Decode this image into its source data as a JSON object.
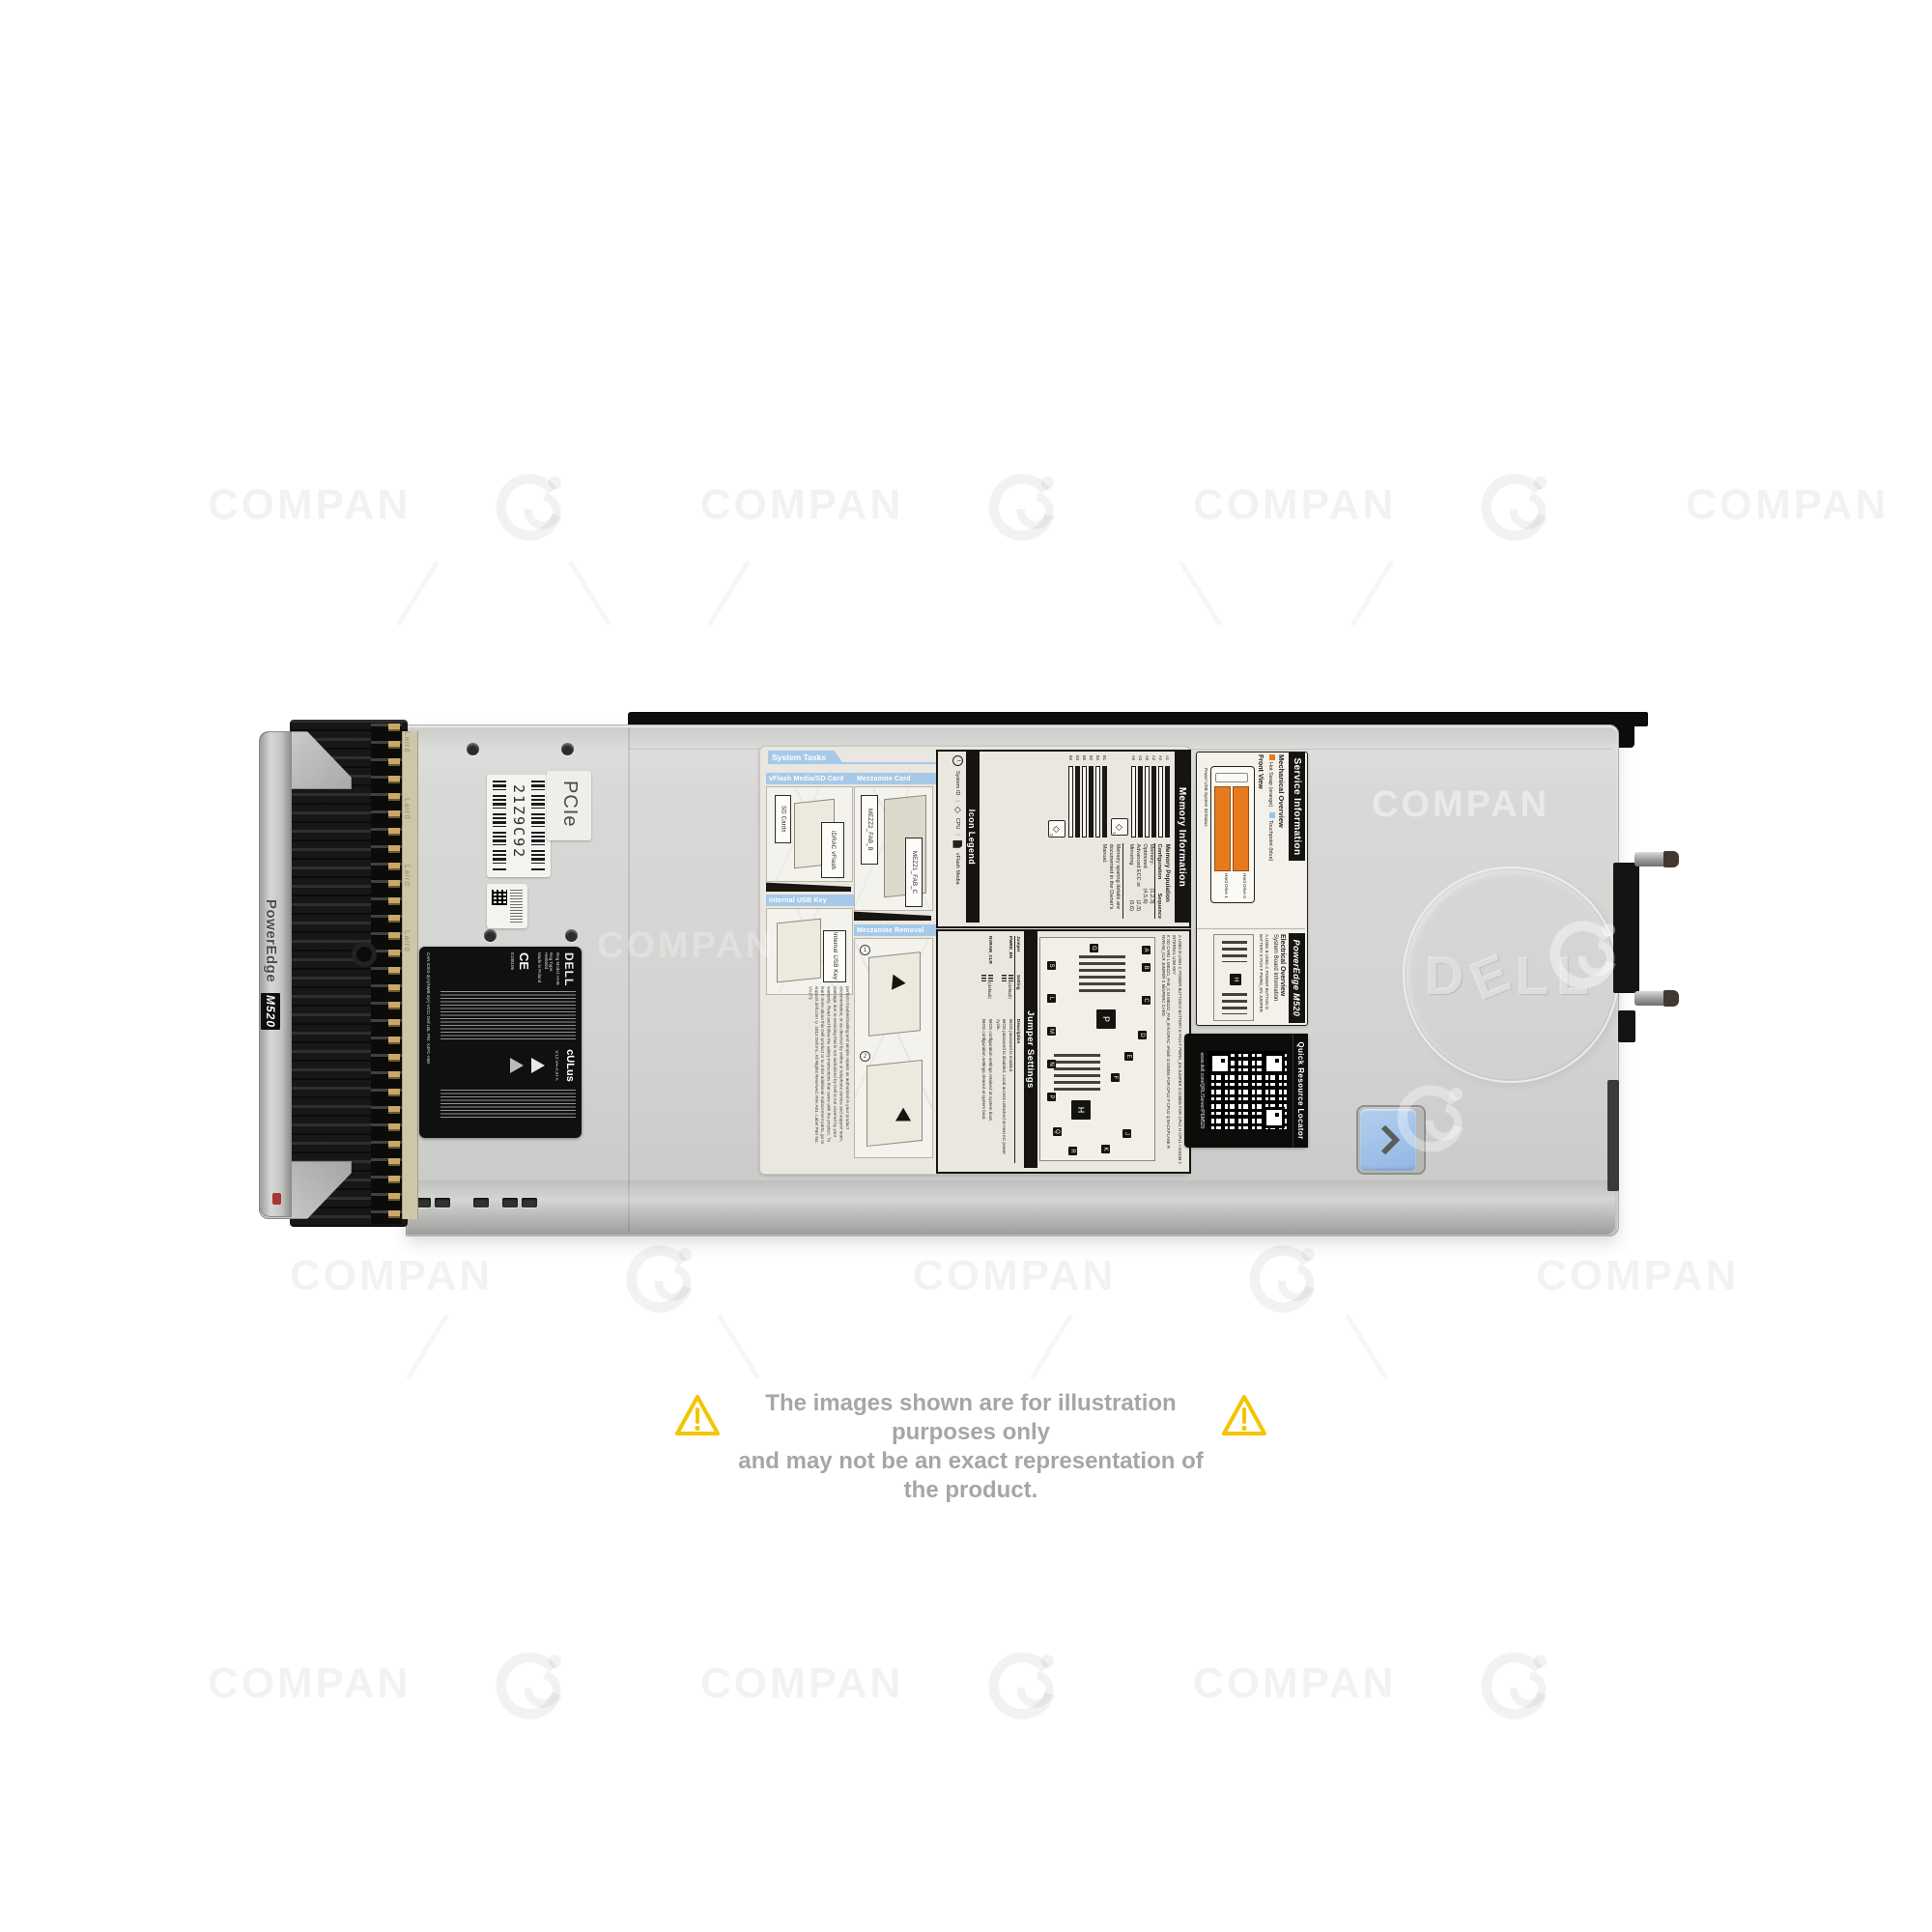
{
  "watermark": {
    "text": "COMPAN"
  },
  "disclaimer": {
    "line1": "The images shown are for illustration purposes only",
    "line2": "and may not be an exact representation of the product."
  },
  "blade": {
    "handle": {
      "brand": "PowerEdge",
      "model": "M520"
    },
    "gasket_text": "Laird",
    "pcie_label": "PCIe",
    "service_tag": "21Z9C92",
    "logo_d": "D",
    "logo_e": "E",
    "logo_ll": "LL",
    "regulatory": {
      "brand": "DELL",
      "reg_model": "Reg Model: HHB",
      "reg_type": "Reg Type: HM660d",
      "made_in": "Made in Poland",
      "cert_ce": "CE",
      "cert_ul": "cULus",
      "cert_e": "E105106",
      "rating": "V:12 V⎓  A:37 A",
      "cert_line": "CAN ICES-3(A)/NMB-3(A)   VCCI   Dell LBL P/N: X4FC-A00"
    },
    "tasks_label": {
      "tab": "System Tasks",
      "sec_vflash": "vFlash Media/SD Card",
      "sec_mezz": "Mezzanine Card",
      "sec_usb": "Internal USB Key",
      "sec_mezz_removal": "Mezzanine Removal",
      "callout_sd": "SD Cards",
      "callout_idrac": "iDRAC vFlash",
      "callout_usb": "Internal USB Key",
      "callout_mezz2": "MEZZ2_FAB_B",
      "callout_mezz1": "MEZZ1_FAB_C",
      "step1": "1",
      "step2": "2",
      "caution1": "Caution: Memory (DIMMs) and CPUs may be hot during servicing.",
      "caution2": "Caution: Many repairs may only be done by a certified service technician. You should only perform troubleshooting and simple repairs as authorized in your product documentation, or as directed by online or telephone service and support team. Damage due to servicing that is not authorized by Dell is not covered by your warranty. Read and follow the safety instructions that came with the product.",
      "footer": "To learn more about this Dell product or to order additional replacement parts, go to support.dell.com",
      "copyright": "© 2012 Dell Inc. All Rights Reserved. Rev A01. Label Part No. VVJ73"
    },
    "icon_legend": {
      "title": "Icon Legend",
      "item_sysid": "System ID",
      "item_cpu": "CPU",
      "item_vflash": "vFlash Media"
    },
    "memory_info": {
      "title": "Memory Information",
      "population": "Memory Population",
      "col_config": "Configuration",
      "col_seq": "Sequence",
      "row1_name": "Memory-Optimized",
      "row1_seq": "(1,2,3)(4,5,6)",
      "row2_name": "Advanced ECC or Mirroring",
      "row2_seq": "(2,3)(5,6)",
      "note": "Memory sparing details are documented in the Owner's Manual.",
      "cpu1_chip": "1",
      "cpu2_chip": "2",
      "diamond": "◇",
      "slots_a": [
        "A1",
        "A4",
        "A2",
        "A5",
        "A3",
        "A6"
      ],
      "slots_b": [
        "B1",
        "B4",
        "B2",
        "B5",
        "B3",
        "B6"
      ]
    },
    "jumper": {
      "title": "Jumper Settings",
      "col_jumper": "Jumper",
      "col_setting": "Setting",
      "col_desc": "Description",
      "j1": "PWRD_EN",
      "j1_default": "(default)",
      "j1_desc1": "BIOS password is enabled.",
      "j1_desc2": "BIOS password is disabled. Local access unlocked at next AC power cycle.",
      "j2": "NVRAM_CLR",
      "j2_default": "(default)",
      "j2_desc1": "BIOS configuration settings retained at system boot.",
      "j2_desc2": "BIOS configuration settings cleared at system boot.",
      "legend_row1": "A USB2   B USB1   C POWER BUTTON   D BATTERY   E PCH   F PWRD_EN JUMPER   G DIMMs FOR CPU1   H CPU1   I IDSDM   J INTERNAL USB KEY",
      "legend_row2": "K SD CARD   L MEZZ1_FAB_C   M MEZZ2_FAB_B   N iDRAC vFlash   O DIMMs FOR CPU2   P CPU2   Q BACKPLANE   R NVRAM_CLR JUMPER   S MiniPERC CARD",
      "markers": [
        "A",
        "B",
        "C",
        "D",
        "E",
        "F",
        "G",
        "H",
        "J",
        "K",
        "L",
        "M",
        "N",
        "P",
        "Q",
        "R",
        "S"
      ]
    },
    "service_info": {
      "title": "Service Information",
      "mechanical": "Mechanical Overview",
      "legend_orange": "Hot Swap (orange)",
      "legend_blue": "Touchpoint (blue)",
      "front_view": "Front View",
      "drive0": "Hard Drive 0",
      "drive1": "Hard Drive 1",
      "ports": "Power   USB   System ID/Status",
      "model": "PowerEdge M520",
      "electrical": "Electrical Overview",
      "board": "System Board Information",
      "legend_af": "A USB2   B USB1   C POWER BUTTON   D BATTERY   E PCH   F PWRD_EN JUMPER",
      "qrl_title": "Quick Resource Locator",
      "qrl_url": "www.dell.com/QRL/Server/PEM520"
    },
    "colors": {
      "hot_swap_orange": "#e87a1e",
      "touchpoint_blue": "#9cc3ea",
      "header_blue": "#a6c9e8",
      "warning_yellow": "#f2c500"
    }
  }
}
